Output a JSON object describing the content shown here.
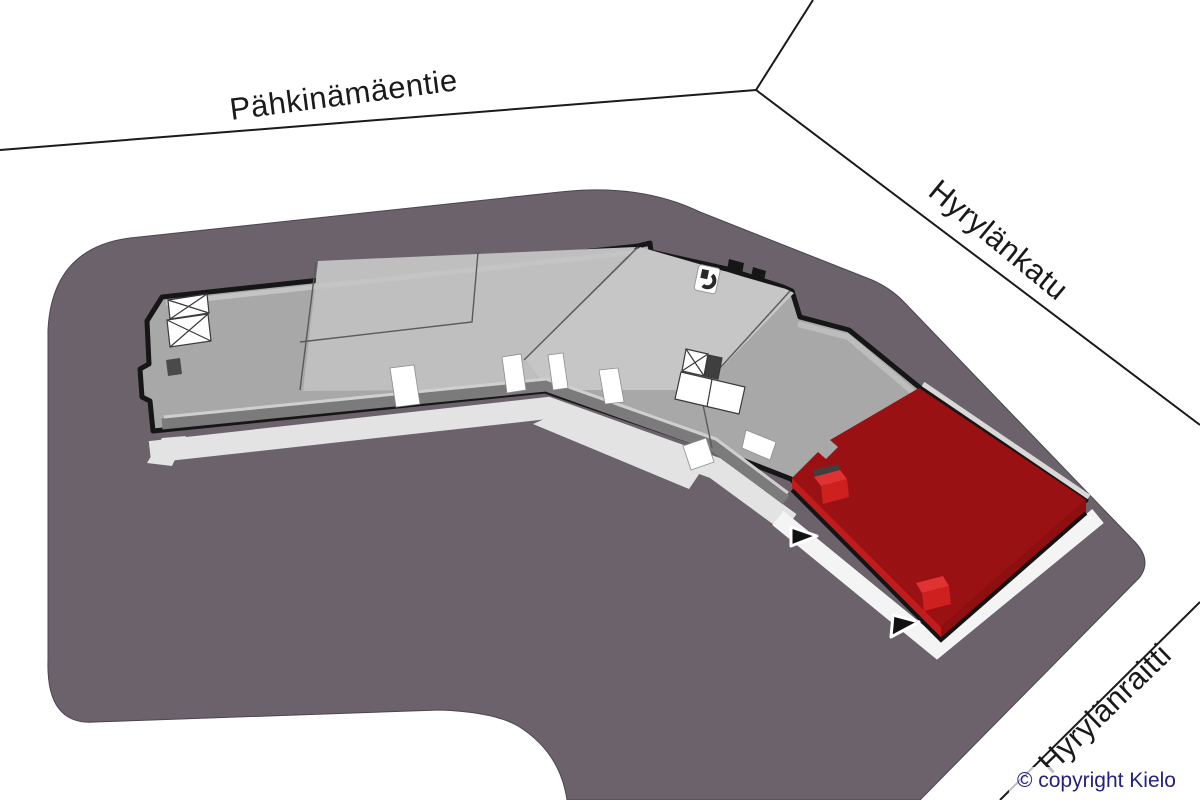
{
  "scene": {
    "description": "Isometric site plan of a commercial building with one highlighted unit",
    "streets": {
      "top": {
        "label": "Pähkinämäentie"
      },
      "right": {
        "label": "Hyrylänkatu"
      },
      "bottom_right": {
        "label": "Hyrylänraitti"
      }
    },
    "copyright": {
      "text": "© copyright Kielo"
    },
    "building": {
      "name": "building-floorplan",
      "highlighted_unit": {
        "name": "available-unit",
        "color_top": "#9a1113"
      },
      "entrance_arrow_count": 2,
      "stairwell_count": 2,
      "icons": [
        "wc-icon",
        "stairs-icon",
        "elevator-core"
      ]
    },
    "colors": {
      "background": "#ffffff",
      "parcel": "#6b626c",
      "street_line": "#1a1a1a",
      "label_text": "#1a1a1a",
      "copyright_text": "#23237e",
      "floor": "#a8a8a8",
      "floor_mid_unit": "#bfbfbf",
      "floor_bend_unit": "#c6c6c6",
      "wall_outline": "#161616",
      "parapet": "#7b7b7b",
      "parapet_light": "#cfcfcf",
      "sidewalk": "#e3e3e3",
      "walkway_white": "#f4f4f4",
      "unit_top": "#9a1113",
      "unit_side_bright": "#c41a1a",
      "unit_side_dark": "#8f0f10",
      "unit_door_top": "#e03232",
      "unit_door_front": "#cf2020",
      "lintel": "#3f3f3f",
      "arrow_fill": "#111111"
    }
  }
}
